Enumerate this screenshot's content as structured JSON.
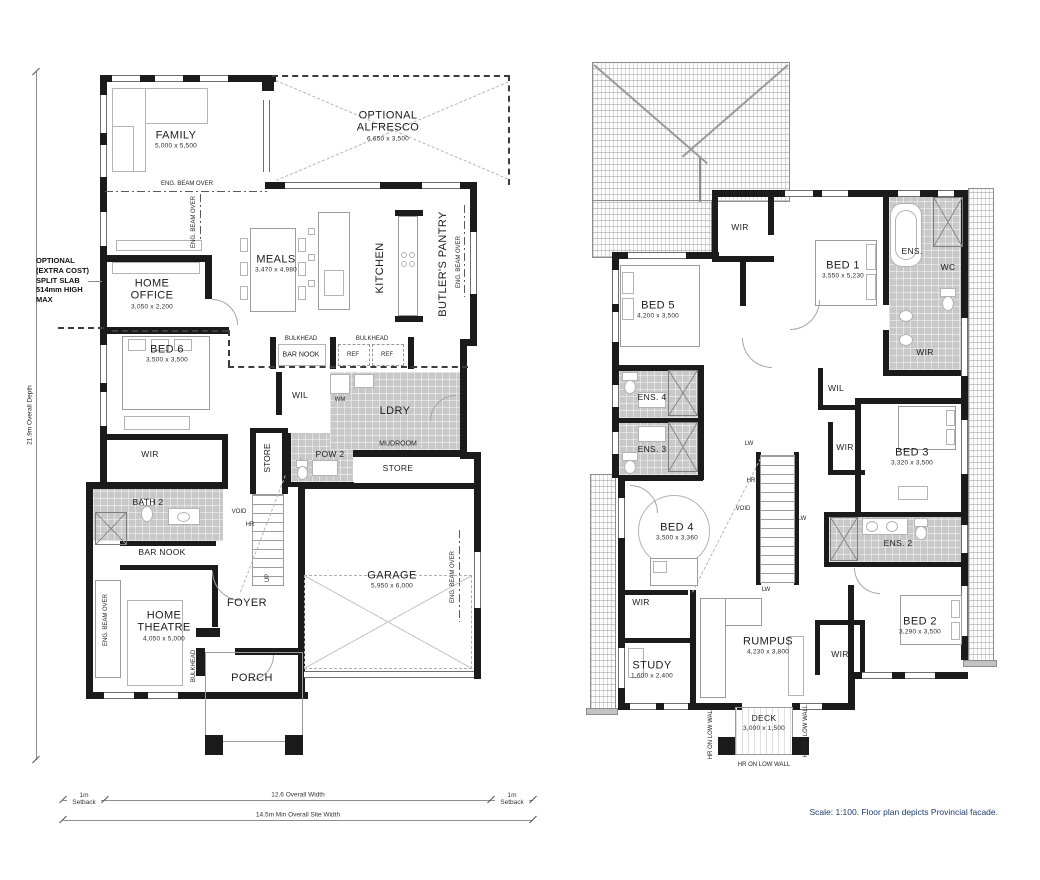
{
  "ground_floor": {
    "rooms": {
      "family": {
        "name": "FAMILY",
        "dim": "5,000 x 5,500"
      },
      "alfresco": {
        "name": "OPTIONAL ALFRESCO",
        "dim": "6,650 x 3,500"
      },
      "meals": {
        "name": "MEALS",
        "dim": "3,470 x 4,980"
      },
      "kitchen": {
        "name": "KITCHEN"
      },
      "butlers_pantry": {
        "name": "BUTLER'S PANTRY"
      },
      "home_office": {
        "name": "HOME OFFICE",
        "dim": "3,050 x 2,200"
      },
      "bed6": {
        "name": "BED 6",
        "dim": "3,500 x 3,500"
      },
      "wir": {
        "name": "WIR"
      },
      "bath2": {
        "name": "BATH 2"
      },
      "bar_nook": {
        "name": "BAR NOOK"
      },
      "wil": {
        "name": "WIL"
      },
      "ldry": {
        "name": "LDRY"
      },
      "mudroom": {
        "name": "MUDROOM"
      },
      "pow2": {
        "name": "POW 2"
      },
      "store": {
        "name": "STORE"
      },
      "garage": {
        "name": "GARAGE",
        "dim": "5,950 x 6,000"
      },
      "foyer": {
        "name": "FOYER"
      },
      "porch": {
        "name": "PORCH"
      },
      "home_theatre": {
        "name": "HOME THEATRE",
        "dim": "4,050 x 5,000"
      }
    },
    "small": {
      "bulkhead": "BULKHEAD",
      "ref": "REF",
      "wm": "WM",
      "void": "VOID",
      "hr": "HR",
      "up": "UP",
      "eng_beam": "ENG. BEAM OVER"
    },
    "note_split_slab": "OPTIONAL (EXTRA COST) SPLIT SLAB 514mm HIGH MAX"
  },
  "first_floor": {
    "rooms": {
      "wir": {
        "name": "WIR"
      },
      "wil": {
        "name": "WIL"
      },
      "bed1": {
        "name": "BED 1",
        "dim": "3,550 x 5,230"
      },
      "bed2": {
        "name": "BED 2",
        "dim": "3,290 x 3,500"
      },
      "bed3": {
        "name": "BED 3",
        "dim": "3,320 x 3,500"
      },
      "bed4": {
        "name": "BED 4",
        "dim": "3,500 x 3,360"
      },
      "bed5": {
        "name": "BED 5",
        "dim": "4,200 x 3,500"
      },
      "ens1": {
        "name": "ENS."
      },
      "ens2": {
        "name": "ENS. 2"
      },
      "ens3": {
        "name": "ENS. 3"
      },
      "ens4": {
        "name": "ENS. 4"
      },
      "wc": {
        "name": "WC"
      },
      "study": {
        "name": "STUDY",
        "dim": "1,600 x 2,400"
      },
      "rumpus": {
        "name": "RUMPUS",
        "dim": "4,230 x 3,800"
      },
      "deck": {
        "name": "DECK",
        "dim": "3,000 x 1,500"
      }
    },
    "small": {
      "lw": "LW",
      "hr": "HR",
      "void": "VOID",
      "hr_low_wall": "HR ON LOW WALL"
    }
  },
  "dimensions": {
    "overall_depth": "21.9m Overall Depth",
    "setback": "1m Setback",
    "overall_width": "12.6 Overall Width",
    "site_width": "14.5m Min Overall Site Width"
  },
  "footer": {
    "scale_note": "Scale: 1:100. Floor plan depicts Provincial facade."
  },
  "colors": {
    "wall": "#1b1b1b",
    "wet_area": "#c8c8c8",
    "note_text": "#1f3a6e"
  }
}
